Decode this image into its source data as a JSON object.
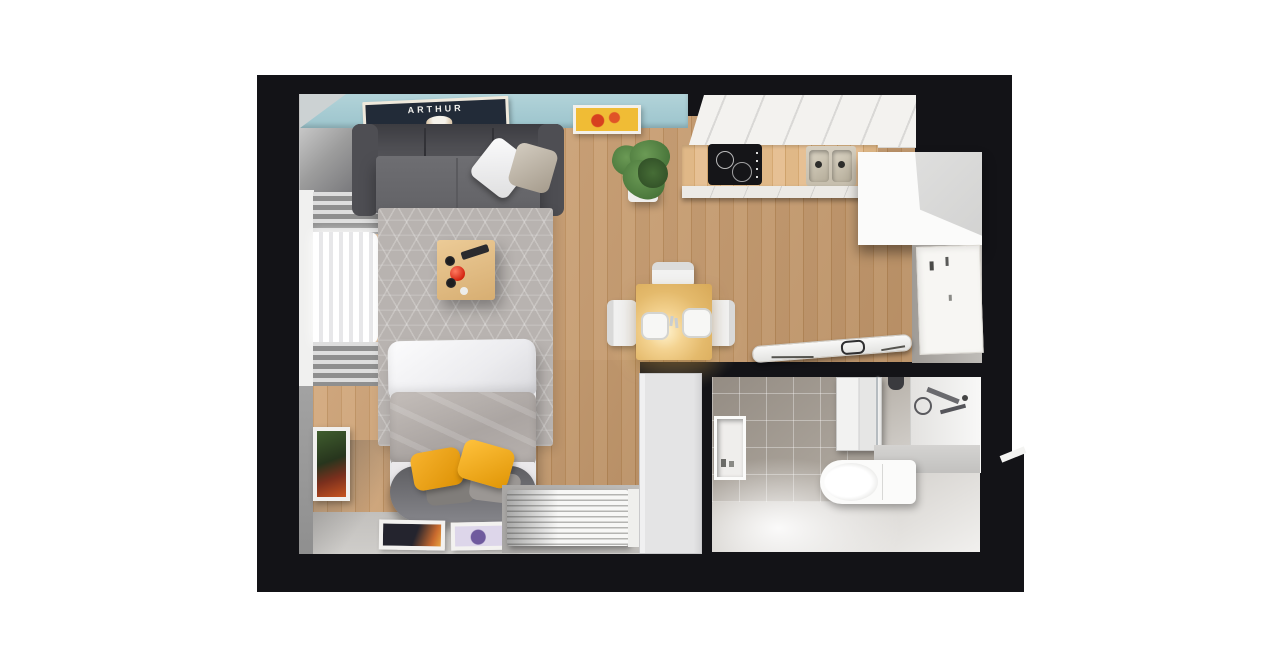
{
  "poster": {
    "text": "ARTHUR"
  },
  "palette": {
    "wall-black": "#131317",
    "teal": "#b2d3d9",
    "wood-a": "#cb9e70",
    "wood-b": "#d2a678",
    "rug": "#b8b3b0",
    "sofa-dark": "#57575c",
    "sofa-mid": "#6e6e72",
    "bed-gray": "#aba5a2",
    "yellow-a": "#f7b32e",
    "yellow-b": "#dd9104",
    "radiator": "#f7f7f6",
    "mat": "#a9a7a5",
    "bottom-band": "#c2c0bd",
    "tile": "#948c83",
    "slab": "#e4e4e5",
    "entry-wall": "#9f9b96",
    "door": "#f7f6f3",
    "white-soft": "#f3f2ef",
    "counter-a": "#e0b887",
    "counter-b": "#e6c094",
    "hob": "#151518",
    "sink": "#d6cfc0",
    "table-a": "#fff3cf",
    "table-b": "#e4ba6c",
    "plant-a": "#6b9a55",
    "plant-b": "#3f6b33",
    "art-yellow": "#f0bc35",
    "art-red": "#d7401f",
    "poster-navy": "#222b38"
  }
}
